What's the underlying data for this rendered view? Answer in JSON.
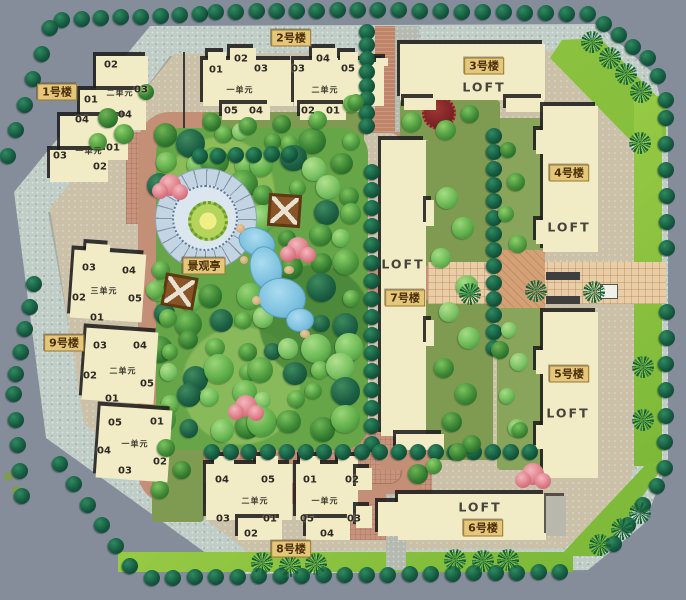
{
  "plan": {
    "pavilion_label": "景观亭"
  },
  "buildings": {
    "b1": {
      "label": "1号楼",
      "units": [
        {
          "name": "二单元",
          "numbers": [
            "02",
            "03",
            "01",
            "04",
            "04"
          ]
        },
        {
          "name": "一单元",
          "numbers": [
            "01",
            "03",
            "02"
          ]
        }
      ]
    },
    "b2": {
      "label": "2号楼",
      "units": [
        {
          "name": "一单元",
          "numbers": [
            "01",
            "02",
            "03",
            "05",
            "04"
          ]
        },
        {
          "name": "二单元",
          "numbers": [
            "03",
            "04",
            "05",
            "02",
            "01"
          ]
        }
      ]
    },
    "b3": {
      "label": "3号楼",
      "loft": "LOFT"
    },
    "b4": {
      "label": "4号楼",
      "loft": "LOFT"
    },
    "b5": {
      "label": "5号楼",
      "loft": "LOFT"
    },
    "b6": {
      "label": "6号楼",
      "loft": "LOFT"
    },
    "b7": {
      "label": "7号楼",
      "loft": "LOFT"
    },
    "b8": {
      "label": "8号楼",
      "units": [
        {
          "name": "二单元",
          "numbers": [
            "04",
            "05",
            "03",
            "01",
            "02"
          ]
        },
        {
          "name": "一单元",
          "numbers": [
            "01",
            "02",
            "05",
            "03",
            "04"
          ]
        }
      ]
    },
    "b9": {
      "label": "9号楼",
      "units": [
        {
          "name": "三单元",
          "numbers": [
            "03",
            "04",
            "02",
            "05",
            "01"
          ]
        },
        {
          "name": "二单元",
          "numbers": [
            "03",
            "04",
            "02",
            "05",
            "01"
          ]
        },
        {
          "name": "一单元",
          "numbers": [
            "05",
            "01",
            "04",
            "02",
            "03"
          ]
        }
      ]
    }
  },
  "colors": {
    "road": "#858d9b",
    "sidewalk": "#c0ccc6",
    "lawn": "#8ac23f",
    "ground": "#cbc1a9",
    "path_pink": "#c48f77",
    "path_tan": "#e9cda6",
    "building": "#f2ecc6",
    "tree_dark": "#12553c",
    "water": "#7cc0de",
    "label_bg": "#e5c77c"
  }
}
